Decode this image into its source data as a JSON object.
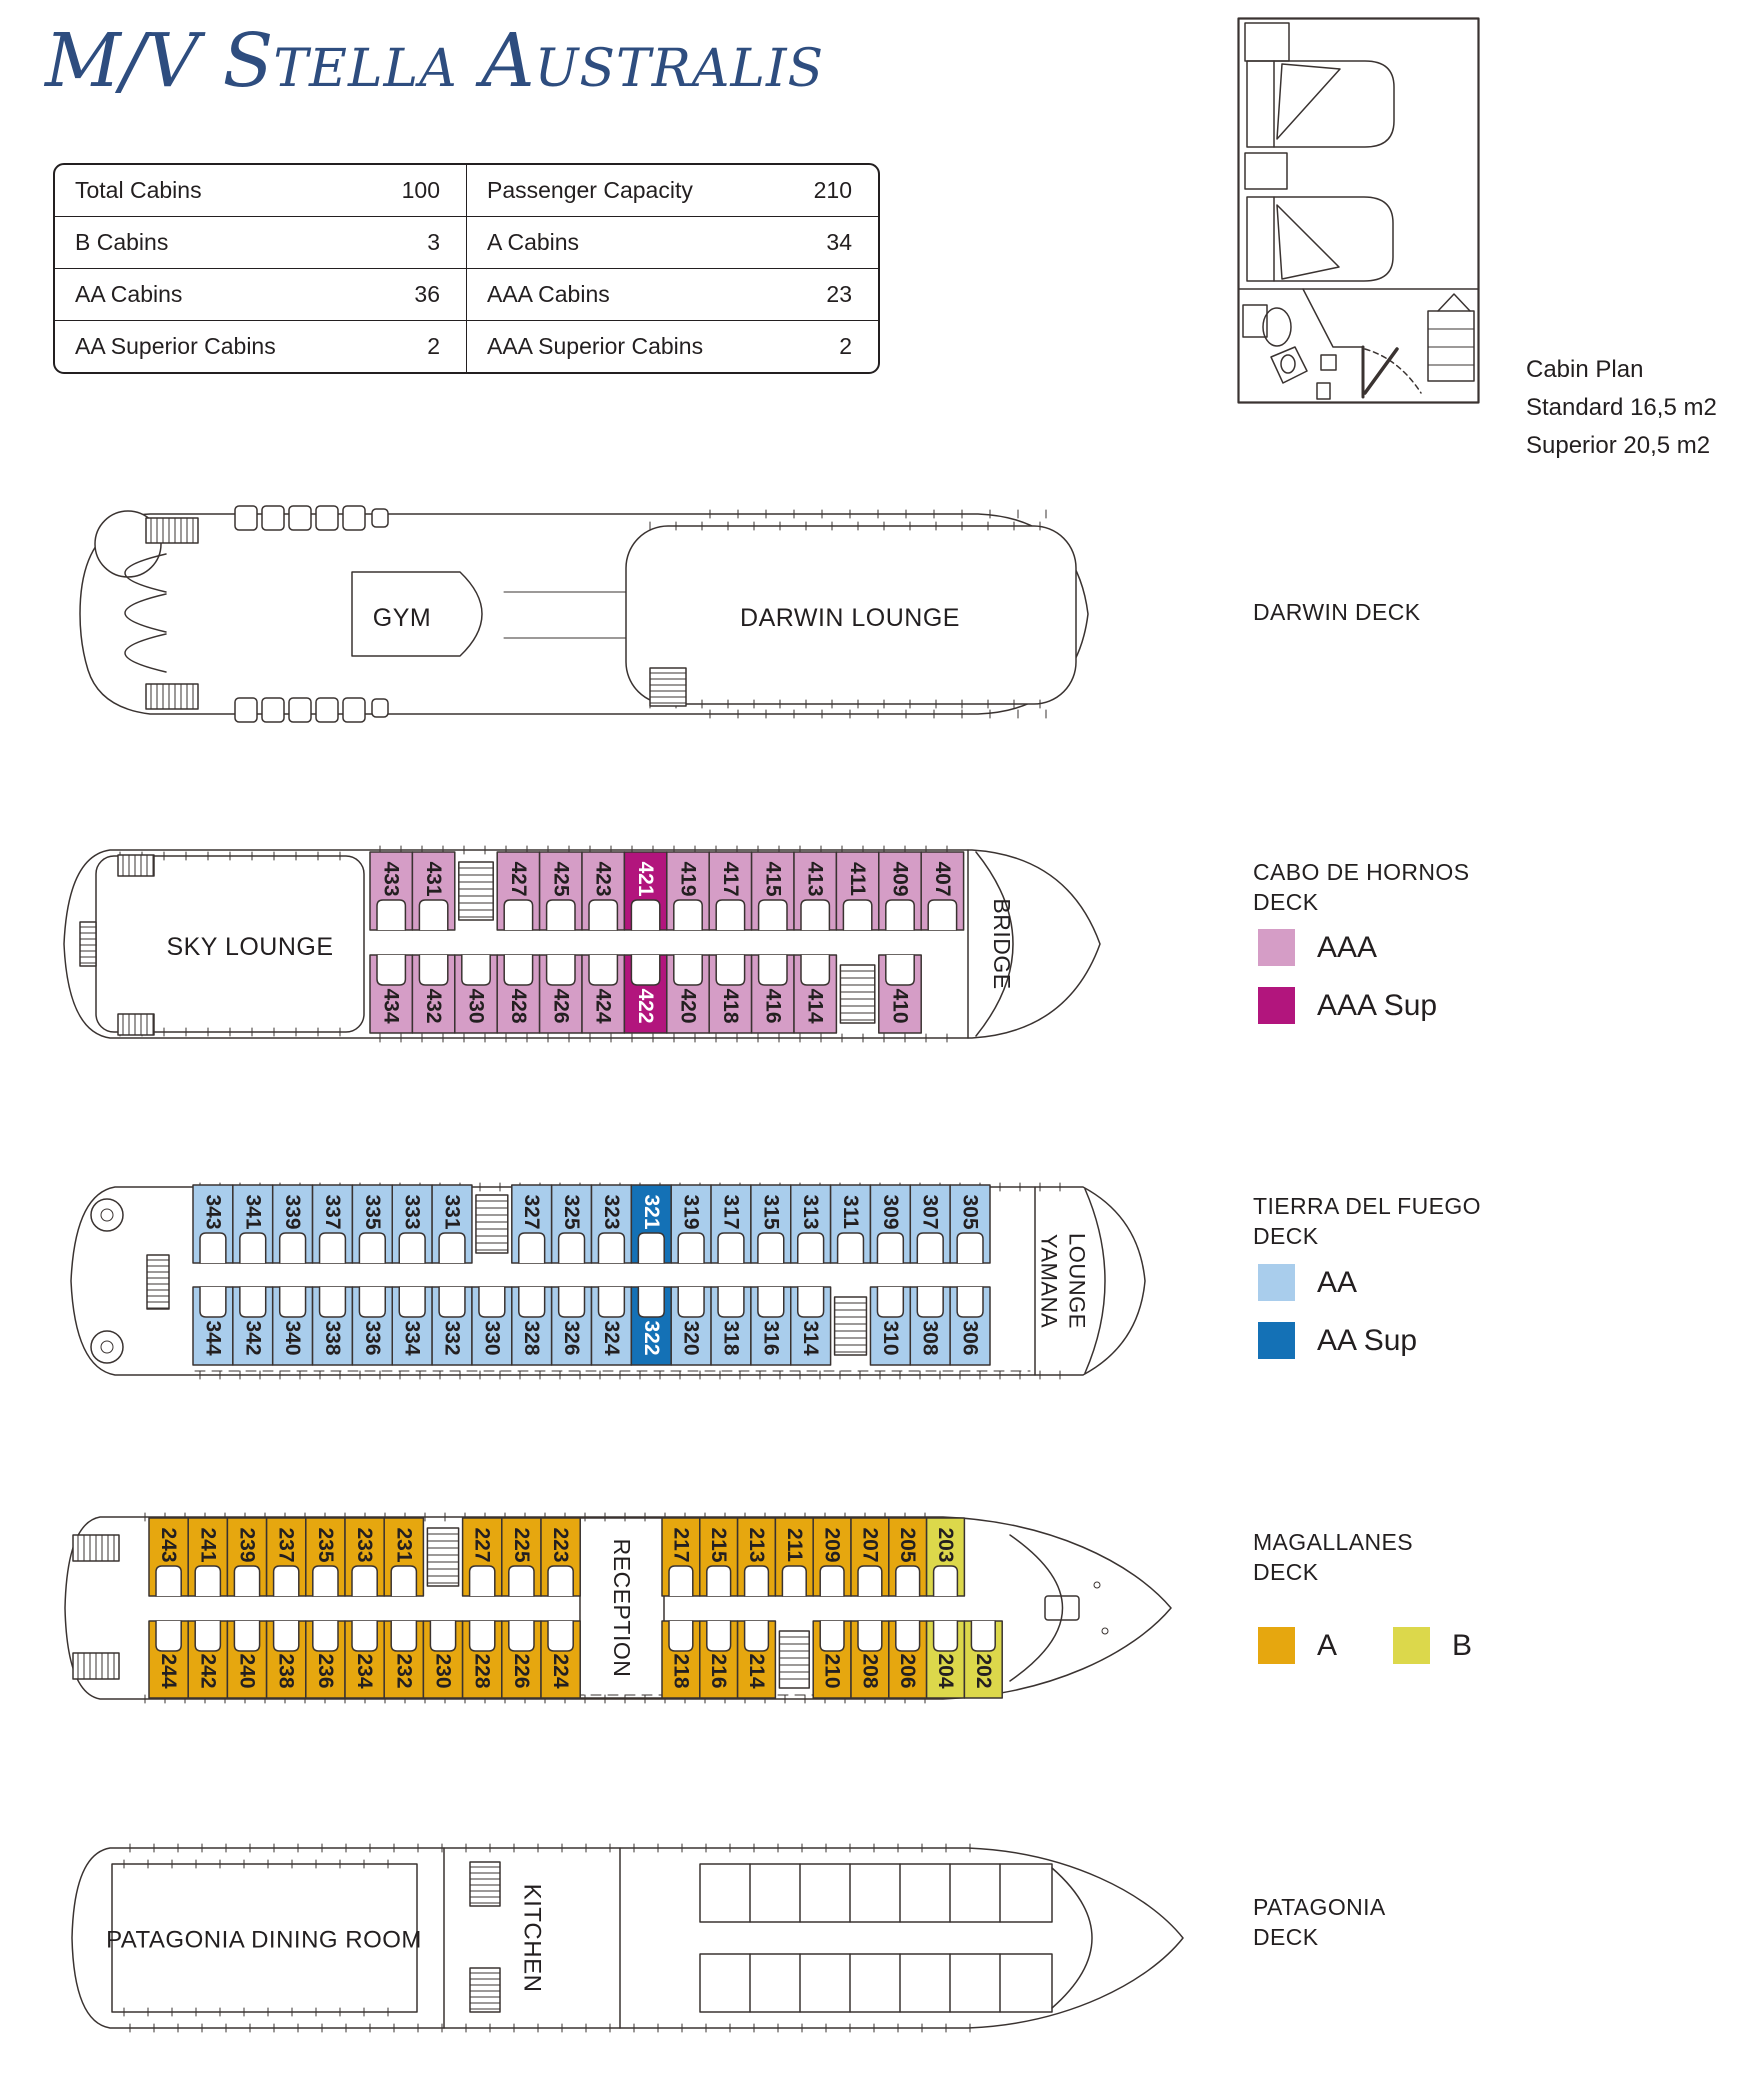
{
  "title": {
    "parts": [
      "M/V S",
      "TELLA",
      " A",
      "USTRALIS"
    ]
  },
  "info_table": {
    "rows": [
      [
        "Total Cabins",
        "100",
        "Passenger Capacity",
        "210"
      ],
      [
        "B Cabins",
        "3",
        "A Cabins",
        "34"
      ],
      [
        "AA Cabins",
        "36",
        "AAA Cabins",
        "23"
      ],
      [
        "AA Superior Cabins",
        "2",
        "AAA Superior Cabins",
        "2"
      ]
    ]
  },
  "cabin_plan": {
    "caption": [
      "Cabin Plan",
      "Standard 16,5 m2",
      "Superior 20,5 m2"
    ]
  },
  "colors": {
    "AAA": "#d59dc6",
    "AAA_SUP": "#b2157d",
    "AA": "#a9cdec",
    "AA_SUP": "#1471b6",
    "A": "#e6a70f",
    "B": "#dcd84b",
    "line": "#3a3331",
    "text": "#231f20",
    "title_blue": "#2e4d7f"
  },
  "decks": [
    {
      "id": "darwin",
      "label_lines": [
        "DARWIN DECK"
      ],
      "rooms": [
        {
          "name": "GYM"
        },
        {
          "name": "DARWIN LOUNGE"
        }
      ]
    },
    {
      "id": "cabo",
      "label_lines": [
        "CABO DE HORNOS",
        "DECK"
      ],
      "rooms": [
        {
          "name": "SKY LOUNGE"
        },
        {
          "name": "BRIDGE"
        }
      ],
      "legend": [
        {
          "type": "AAA",
          "label": "AAA"
        },
        {
          "type": "AAA_SUP",
          "label": "AAA Sup"
        }
      ],
      "row_top": [
        [
          "433",
          "431",
          "ST",
          "427",
          "425",
          "423",
          "421*",
          "419",
          "417",
          "415",
          "413",
          "411",
          "409",
          "407"
        ]
      ],
      "row_bottom": [
        [
          "434",
          "432",
          "430",
          "428",
          "426",
          "424",
          "422*",
          "420",
          "418",
          "416",
          "414",
          "ST",
          "410"
        ]
      ]
    },
    {
      "id": "tierra",
      "label_lines": [
        "TIERRA DEL FUEGO",
        "DECK"
      ],
      "rooms": [
        {
          "name": "YAMANA LOUNGE"
        }
      ],
      "legend": [
        {
          "type": "AA",
          "label": "AA"
        },
        {
          "type": "AA_SUP",
          "label": "AA Sup"
        }
      ],
      "row_top": [
        [
          "343",
          "341",
          "339",
          "337",
          "335",
          "333",
          "331",
          "ST",
          "327",
          "325",
          "323",
          "321*",
          "319",
          "317",
          "315",
          "313",
          "311",
          "309",
          "307",
          "305"
        ]
      ],
      "row_bottom": [
        [
          "344",
          "342",
          "340",
          "338",
          "336",
          "334",
          "332",
          "330",
          "328",
          "326",
          "324",
          "322*",
          "320",
          "318",
          "316",
          "314",
          "ST",
          "310",
          "308",
          "306"
        ]
      ]
    },
    {
      "id": "magallanes",
      "label_lines": [
        "MAGALLANES",
        "DECK"
      ],
      "rooms": [
        {
          "name": "RECEPTION"
        }
      ],
      "legend": [
        {
          "type": "A",
          "label": "A"
        },
        {
          "type": "B",
          "label": "B"
        }
      ],
      "row_top": [
        [
          "243",
          "241",
          "239",
          "237",
          "235",
          "233",
          "231",
          "ST",
          "227",
          "225",
          "223"
        ],
        [
          "217",
          "215",
          "213",
          "211",
          "209",
          "207",
          "205",
          "203b"
        ]
      ],
      "row_bottom": [
        [
          "244",
          "242",
          "240",
          "238",
          "236",
          "234",
          "232",
          "230",
          "228",
          "226",
          "224"
        ],
        [
          "218",
          "216",
          "214",
          "ST",
          "210",
          "208",
          "206",
          "204b",
          "202b"
        ]
      ]
    },
    {
      "id": "patagonia",
      "label_lines": [
        "PATAGONIA",
        "DECK"
      ],
      "rooms": [
        {
          "name": "PATAGONIA DINING ROOM"
        },
        {
          "name": "KITCHEN"
        }
      ]
    }
  ]
}
